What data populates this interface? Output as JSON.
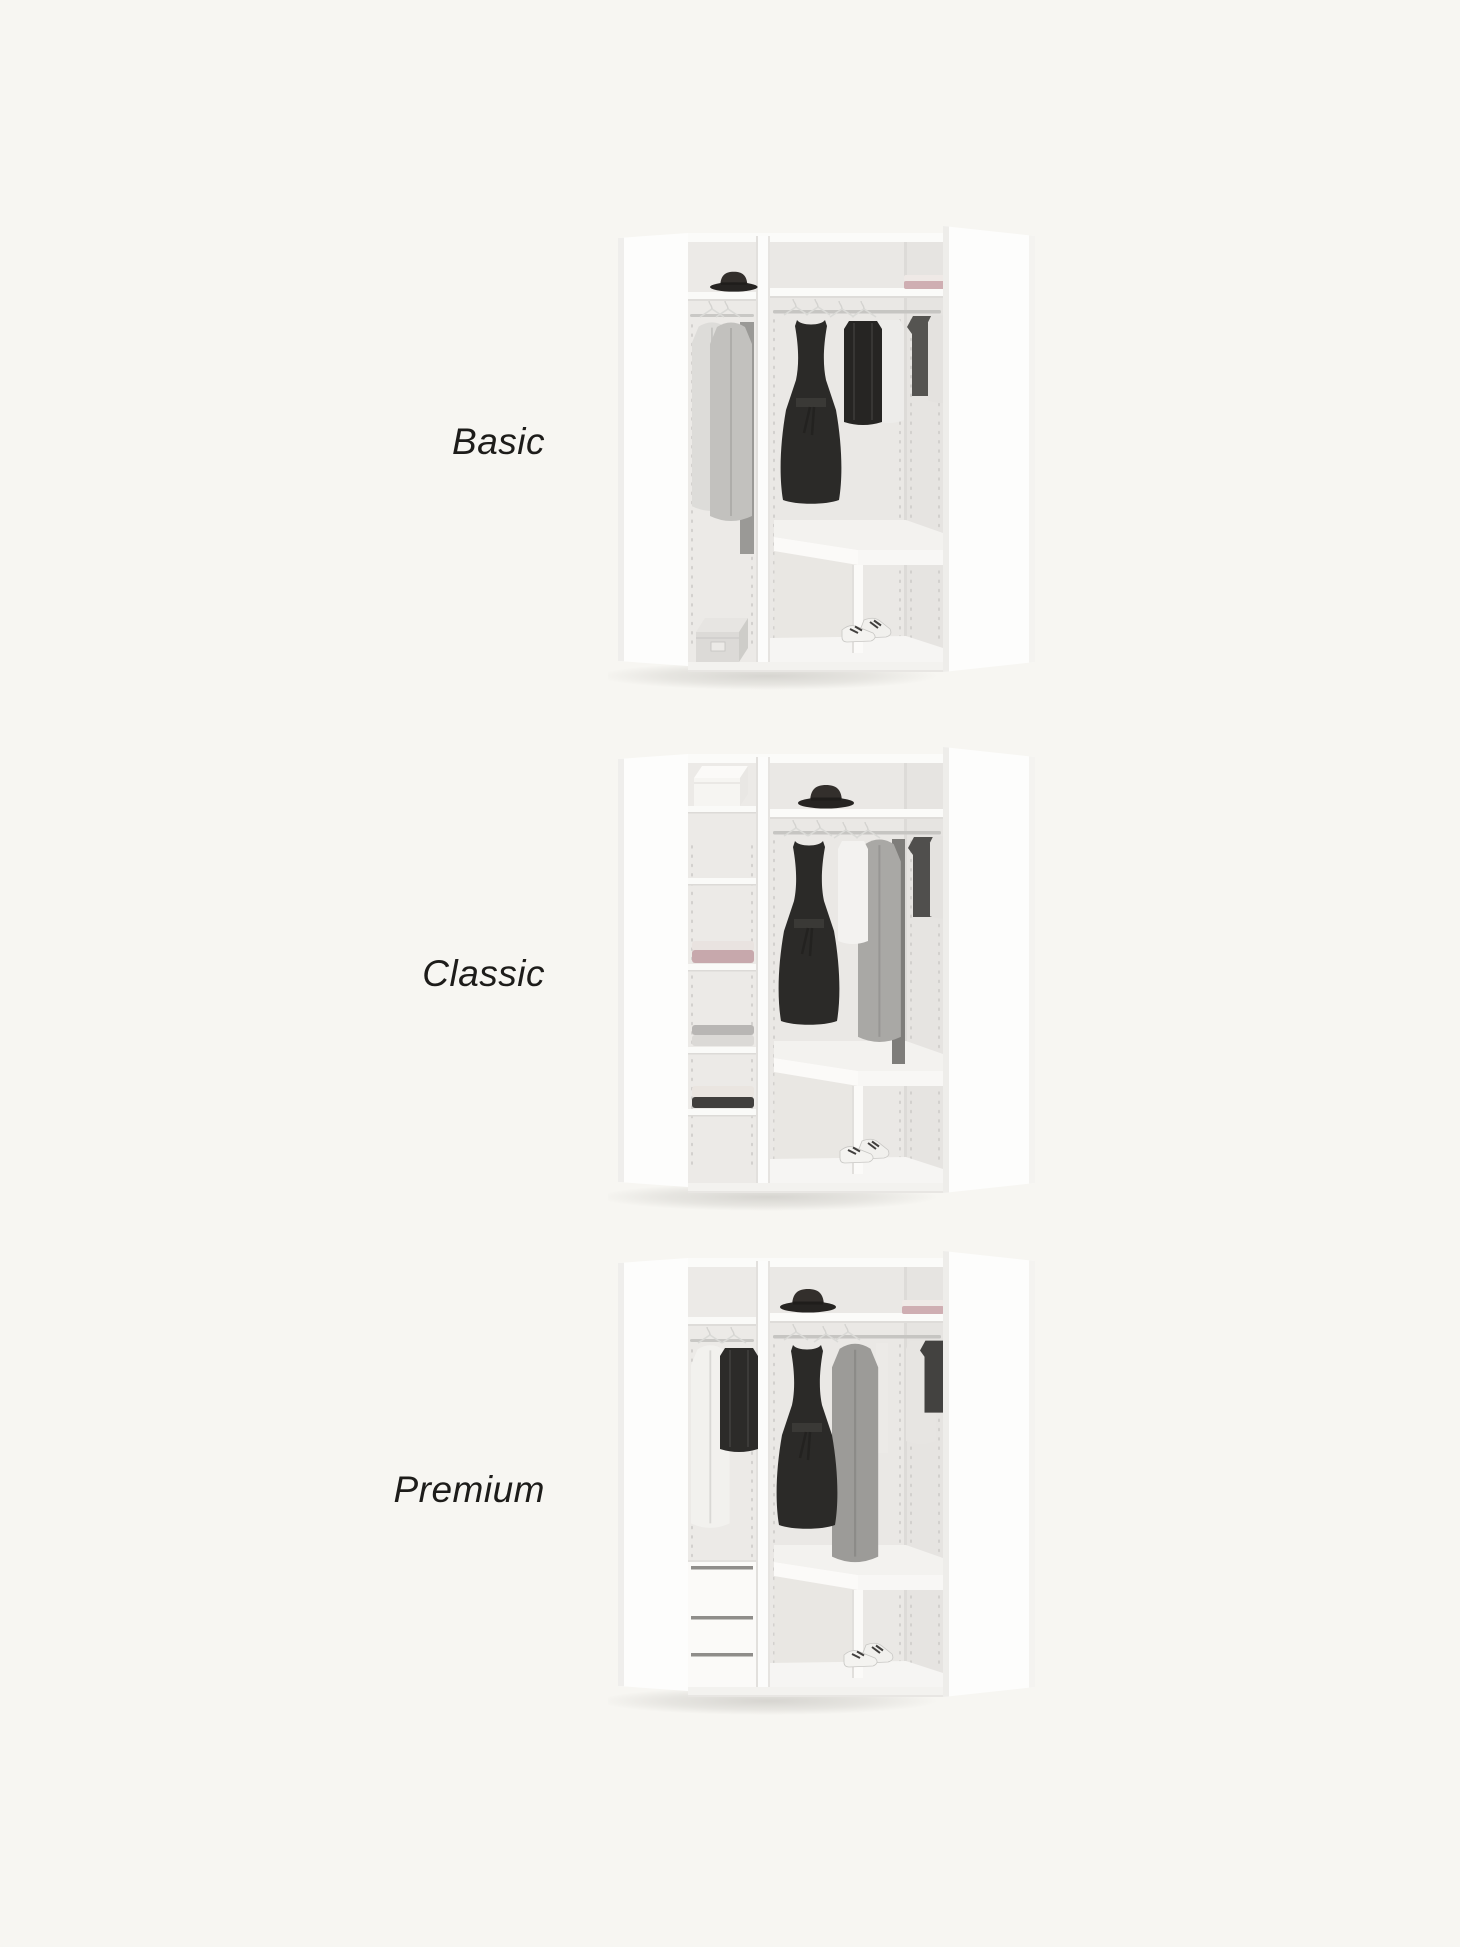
{
  "page": {
    "background_color": "#f7f6f2",
    "label_text_color": "#1d1c1a",
    "wardrobe_body_color": "#fdfdfc",
    "interior_back_color": "#eae8e5",
    "dress_color": "#2b2a28",
    "pink_textile_color": "#c7a8ac"
  },
  "variants": [
    {
      "label": "Basic",
      "image": "corner-wardrobe-basic",
      "visible_objects": [
        "dark-hat",
        "hanging-light-coats",
        "storage-box",
        "black-dress",
        "black-sweater",
        "white-shirt",
        "folded-pink-textile",
        "corner-bench",
        "white-sneakers"
      ]
    },
    {
      "label": "Classic",
      "image": "corner-wardrobe-classic",
      "visible_objects": [
        "white-box",
        "shelf-column",
        "folded-pink-towels",
        "folded-gray-clothes",
        "folded-cream-dark-clothes",
        "black-hat",
        "black-dress",
        "white-blouse",
        "gray-coats",
        "corner-bench",
        "white-sneakers"
      ]
    },
    {
      "label": "Premium",
      "image": "corner-wardrobe-premium",
      "visible_objects": [
        "white-cardigan",
        "black-sweater",
        "three-drawers",
        "black-hat",
        "folded-pink-textile",
        "black-dress",
        "gray-coat",
        "corner-bench",
        "white-sneakers"
      ]
    }
  ]
}
